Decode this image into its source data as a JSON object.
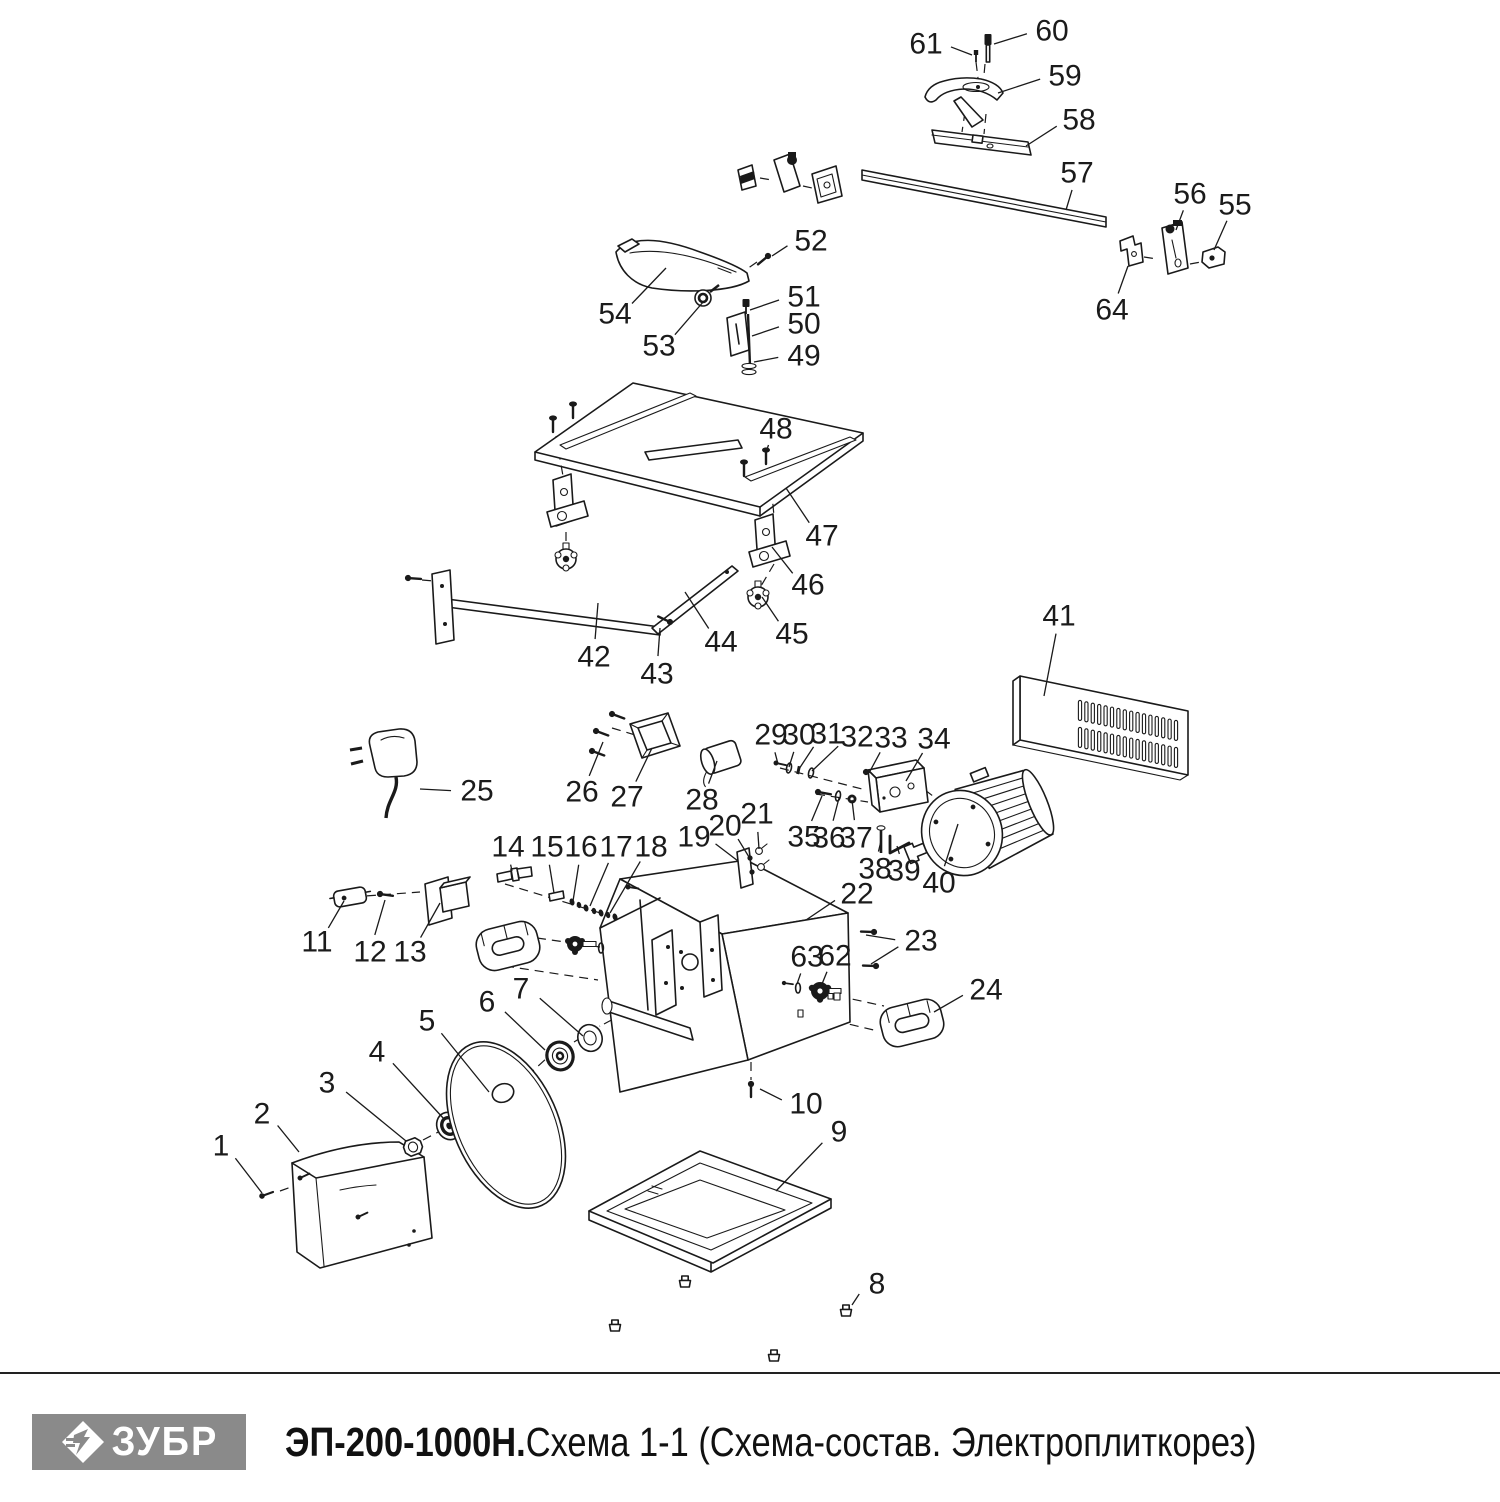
{
  "meta": {
    "width": 1500,
    "height": 1500,
    "background": "#ffffff",
    "line_color": "#1a1a1a",
    "label_color": "#1b1b1b",
    "label_font_size": 30
  },
  "footer": {
    "divider_color": "#222222",
    "logo": {
      "text": "ЗУБР",
      "bg": "#8a8a8a",
      "fg": "#ffffff"
    },
    "title_bold": "ЭП-200-1000Н.",
    "title_rest": " Схема 1-1 (Схема-состав. Электроплиткорез)"
  },
  "diagram": {
    "description": "Схема-состав (exploded parts diagram) электроплиткореза",
    "parts": [
      {
        "num": "1",
        "x": 221,
        "y": 1146,
        "tx": 262,
        "ty": 1193
      },
      {
        "num": "2",
        "x": 262,
        "y": 1114,
        "tx": 299,
        "ty": 1152
      },
      {
        "num": "3",
        "x": 327,
        "y": 1083,
        "tx": 406,
        "ty": 1141
      },
      {
        "num": "4",
        "x": 377,
        "y": 1052,
        "tx": 444,
        "ty": 1119
      },
      {
        "num": "5",
        "x": 427,
        "y": 1021,
        "tx": 489,
        "ty": 1092
      },
      {
        "num": "6",
        "x": 487,
        "y": 1002,
        "tx": 545,
        "ty": 1050
      },
      {
        "num": "7",
        "x": 521,
        "y": 989,
        "tx": 583,
        "ty": 1036
      },
      {
        "num": "8",
        "x": 877,
        "y": 1284,
        "tx": 852,
        "ty": 1305
      },
      {
        "num": "9",
        "x": 839,
        "y": 1132,
        "tx": 776,
        "ty": 1191
      },
      {
        "num": "10",
        "x": 806,
        "y": 1104,
        "tx": 760,
        "ty": 1089
      },
      {
        "num": "11",
        "x": 317,
        "y": 942,
        "tx": 344,
        "ty": 901
      },
      {
        "num": "12",
        "x": 370,
        "y": 952,
        "tx": 385,
        "ty": 900
      },
      {
        "num": "13",
        "x": 410,
        "y": 952,
        "tx": 440,
        "ty": 903
      },
      {
        "num": "14",
        "x": 508,
        "y": 847,
        "tx": 512,
        "ty": 871
      },
      {
        "num": "15",
        "x": 547,
        "y": 847,
        "tx": 554,
        "ty": 893
      },
      {
        "num": "16",
        "x": 581,
        "y": 847,
        "tx": 573,
        "ty": 901
      },
      {
        "num": "17",
        "x": 616,
        "y": 847,
        "tx": 590,
        "ty": 906
      },
      {
        "num": "18",
        "x": 651,
        "y": 847,
        "tx": 610,
        "ty": 913
      },
      {
        "num": "19",
        "x": 694,
        "y": 837,
        "tx": 738,
        "ty": 861
      },
      {
        "num": "20",
        "x": 725,
        "y": 826,
        "tx": 749,
        "ty": 857
      },
      {
        "num": "21",
        "x": 757,
        "y": 814,
        "tx": 759,
        "ty": 849
      },
      {
        "num": "22",
        "x": 857,
        "y": 894,
        "tx": 806,
        "ty": 920
      },
      {
        "num": "23",
        "x": 921,
        "y": 941,
        "tx": 871,
        "ty": 964,
        "tx2": 866,
        "ty2": 935
      },
      {
        "num": "24",
        "x": 986,
        "y": 990,
        "tx": 934,
        "ty": 1012
      },
      {
        "num": "25",
        "x": 477,
        "y": 791,
        "tx": 420,
        "ty": 789
      },
      {
        "num": "26",
        "x": 582,
        "y": 792,
        "tx": 603,
        "ty": 742
      },
      {
        "num": "27",
        "x": 627,
        "y": 797,
        "tx": 652,
        "ty": 748
      },
      {
        "num": "28",
        "x": 702,
        "y": 800,
        "tx": 717,
        "ty": 761
      },
      {
        "num": "29",
        "x": 771,
        "y": 735,
        "tx": 778,
        "ty": 764
      },
      {
        "num": "30",
        "x": 799,
        "y": 735,
        "tx": 789,
        "ty": 767
      },
      {
        "num": "31",
        "x": 827,
        "y": 734,
        "tx": 799,
        "ty": 769
      },
      {
        "num": "32",
        "x": 857,
        "y": 737,
        "tx": 812,
        "ty": 771
      },
      {
        "num": "33",
        "x": 891,
        "y": 738,
        "tx": 869,
        "ty": 773
      },
      {
        "num": "34",
        "x": 934,
        "y": 739,
        "tx": 906,
        "ty": 781
      },
      {
        "num": "35",
        "x": 804,
        "y": 837,
        "tx": 822,
        "ty": 796
      },
      {
        "num": "36",
        "x": 829,
        "y": 838,
        "tx": 839,
        "ty": 798
      },
      {
        "num": "37",
        "x": 856,
        "y": 838,
        "tx": 852,
        "ty": 800
      },
      {
        "num": "38",
        "x": 875,
        "y": 869,
        "tx": 881,
        "ty": 841
      },
      {
        "num": "39",
        "x": 904,
        "y": 871,
        "tx": 897,
        "ty": 846
      },
      {
        "num": "40",
        "x": 939,
        "y": 883,
        "tx": 958,
        "ty": 824
      },
      {
        "num": "41",
        "x": 1059,
        "y": 616,
        "tx": 1044,
        "ty": 696
      },
      {
        "num": "42",
        "x": 594,
        "y": 657,
        "tx": 598,
        "ty": 603
      },
      {
        "num": "43",
        "x": 657,
        "y": 674,
        "tx": 660,
        "ty": 628
      },
      {
        "num": "44",
        "x": 721,
        "y": 642,
        "tx": 685,
        "ty": 592
      },
      {
        "num": "45",
        "x": 792,
        "y": 634,
        "tx": 762,
        "ty": 597
      },
      {
        "num": "46",
        "x": 808,
        "y": 585,
        "tx": 772,
        "ty": 547
      },
      {
        "num": "47",
        "x": 822,
        "y": 536,
        "tx": 786,
        "ty": 488
      },
      {
        "num": "48",
        "x": 776,
        "y": 429,
        "tx": 766,
        "ty": 452
      },
      {
        "num": "49",
        "x": 804,
        "y": 356,
        "tx": 754,
        "ty": 362
      },
      {
        "num": "50",
        "x": 804,
        "y": 324,
        "tx": 752,
        "ty": 336
      },
      {
        "num": "51",
        "x": 804,
        "y": 297,
        "tx": 750,
        "ty": 310
      },
      {
        "num": "52",
        "x": 811,
        "y": 241,
        "tx": 772,
        "ty": 256
      },
      {
        "num": "53",
        "x": 659,
        "y": 346,
        "tx": 704,
        "ty": 301
      },
      {
        "num": "54",
        "x": 615,
        "y": 314,
        "tx": 666,
        "ty": 268
      },
      {
        "num": "55",
        "x": 1235,
        "y": 205,
        "tx": 1214,
        "ty": 250
      },
      {
        "num": "56",
        "x": 1190,
        "y": 194,
        "tx": 1176,
        "ty": 230
      },
      {
        "num": "57",
        "x": 1077,
        "y": 173,
        "tx": 1066,
        "ty": 210
      },
      {
        "num": "58",
        "x": 1079,
        "y": 120,
        "tx": 1026,
        "ty": 146
      },
      {
        "num": "59",
        "x": 1065,
        "y": 76,
        "tx": 998,
        "ty": 93
      },
      {
        "num": "60",
        "x": 1052,
        "y": 31,
        "tx": 994,
        "ty": 44
      },
      {
        "num": "61",
        "x": 926,
        "y": 44,
        "tx": 972,
        "ty": 55
      },
      {
        "num": "62",
        "x": 835,
        "y": 956,
        "tx": 822,
        "ty": 984
      },
      {
        "num": "63",
        "x": 807,
        "y": 957,
        "tx": 797,
        "ty": 984
      },
      {
        "num": "64",
        "x": 1112,
        "y": 310,
        "tx": 1128,
        "ty": 266
      }
    ]
  }
}
